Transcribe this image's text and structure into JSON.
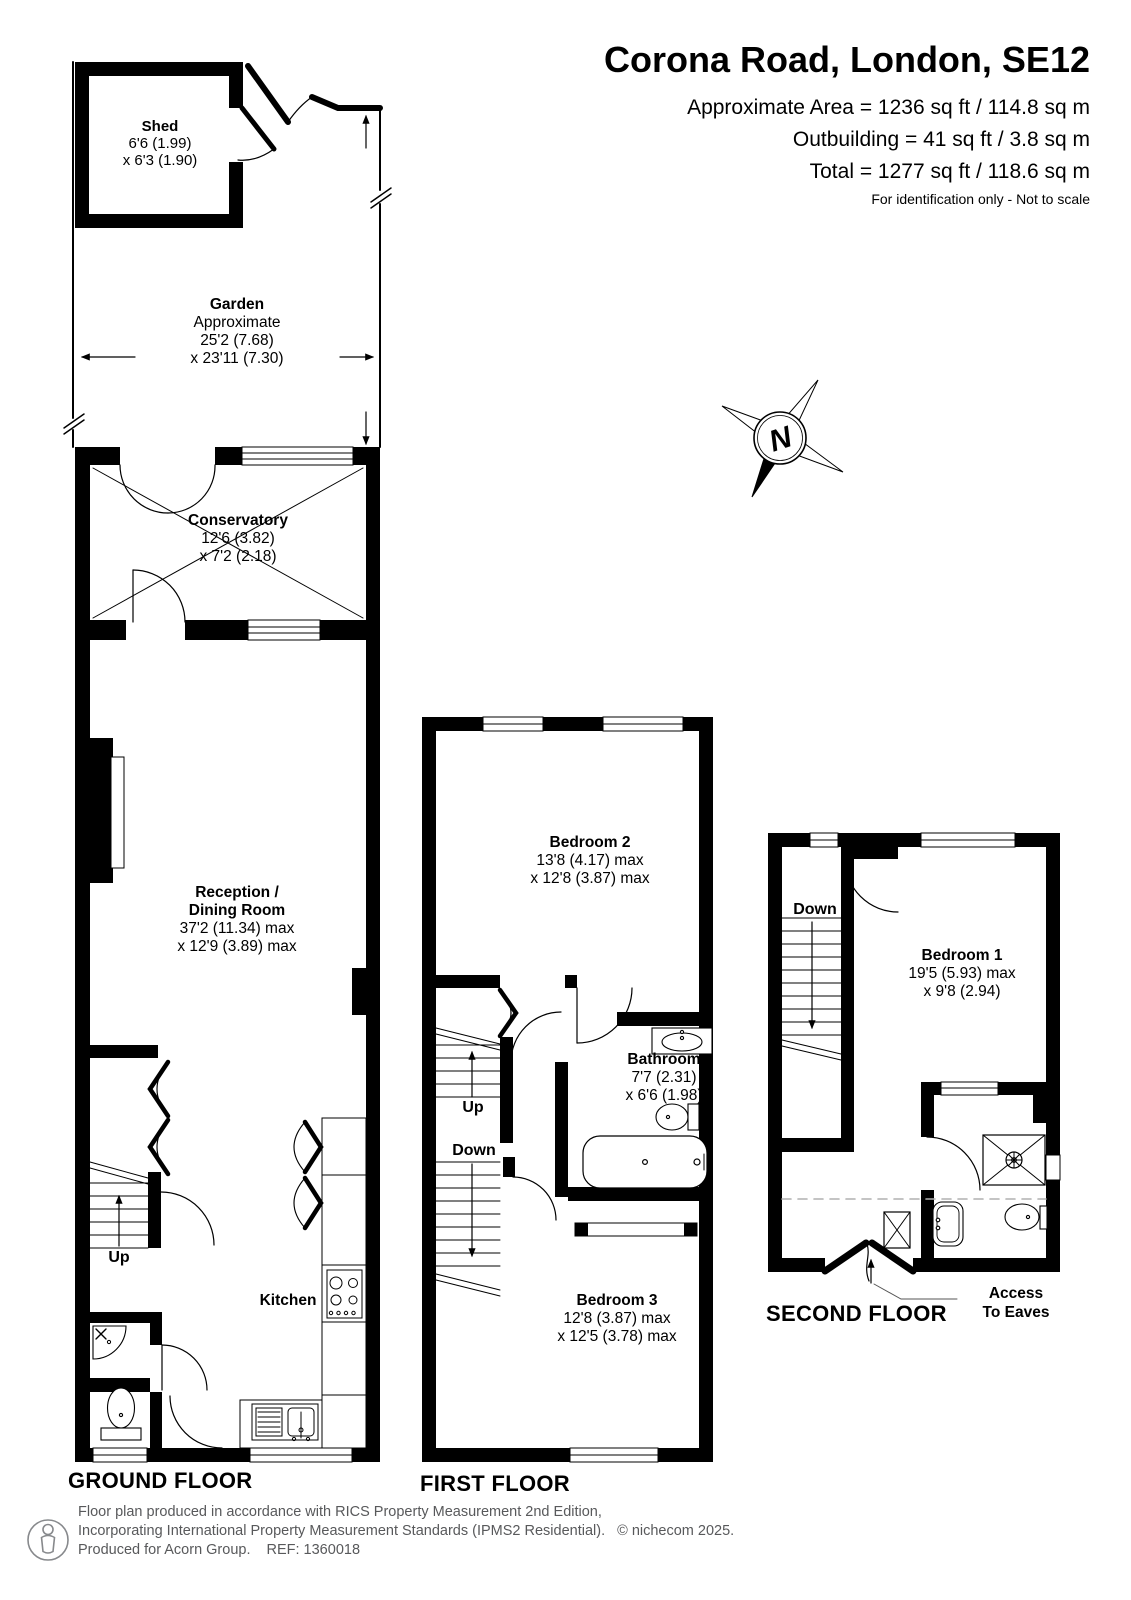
{
  "header": {
    "title": "Corona Road, London, SE12",
    "area_line1": "Approximate Area = 1236 sq ft / 114.8 sq m",
    "area_line2": "Outbuilding = 41 sq ft / 3.8 sq m",
    "area_line3": "Total = 1277 sq ft / 118.6 sq m",
    "note": "For identification only - Not to scale"
  },
  "floors": {
    "ground": {
      "label": "GROUND FLOOR",
      "stairs_up": "Up",
      "rooms": {
        "shed": {
          "name": "Shed",
          "dim1": "6'6 (1.99)",
          "dim2": "x 6'3 (1.90)"
        },
        "garden": {
          "name": "Garden",
          "note": "Approximate",
          "dim1": "25'2 (7.68)",
          "dim2": "x 23'11 (7.30)"
        },
        "conservatory": {
          "name": "Conservatory",
          "dim1": "12'6 (3.82)",
          "dim2": "x 7'2 (2.18)"
        },
        "reception": {
          "name1": "Reception /",
          "name2": "Dining Room",
          "dim1": "37'2 (11.34) max",
          "dim2": "x 12'9 (3.89) max"
        },
        "kitchen": {
          "name": "Kitchen"
        }
      }
    },
    "first": {
      "label": "FIRST FLOOR",
      "stairs_up": "Up",
      "stairs_down": "Down",
      "rooms": {
        "bedroom2": {
          "name": "Bedroom 2",
          "dim1": "13'8 (4.17) max",
          "dim2": "x 12'8 (3.87) max"
        },
        "bathroom": {
          "name": "Bathroom",
          "dim1": "7'7 (2.31)",
          "dim2": "x 6'6 (1.98)"
        },
        "bedroom3": {
          "name": "Bedroom 3",
          "dim1": "12'8 (3.87) max",
          "dim2": "x 12'5 (3.78) max"
        }
      }
    },
    "second": {
      "label": "SECOND FLOOR",
      "stairs_down": "Down",
      "eaves_line1": "Access",
      "eaves_line2": "To Eaves",
      "rooms": {
        "bedroom1": {
          "name": "Bedroom 1",
          "dim1": "19'5 (5.93) max",
          "dim2": "x 9'8 (2.94)"
        }
      }
    }
  },
  "compass": {
    "north": "N"
  },
  "footer": {
    "line1": "Floor plan produced in accordance with RICS Property Measurement 2nd Edition,",
    "line2": "Incorporating International Property Measurement Standards (IPMS2 Residential).",
    "copyright": "© nichecom 2025.",
    "line3": "Produced for Acorn Group.",
    "ref": "REF: 1360018"
  },
  "colors": {
    "wall": "#000000",
    "muted_text": "#58595b",
    "dashed_eaves": "#b0b0b0",
    "background": "#ffffff"
  }
}
